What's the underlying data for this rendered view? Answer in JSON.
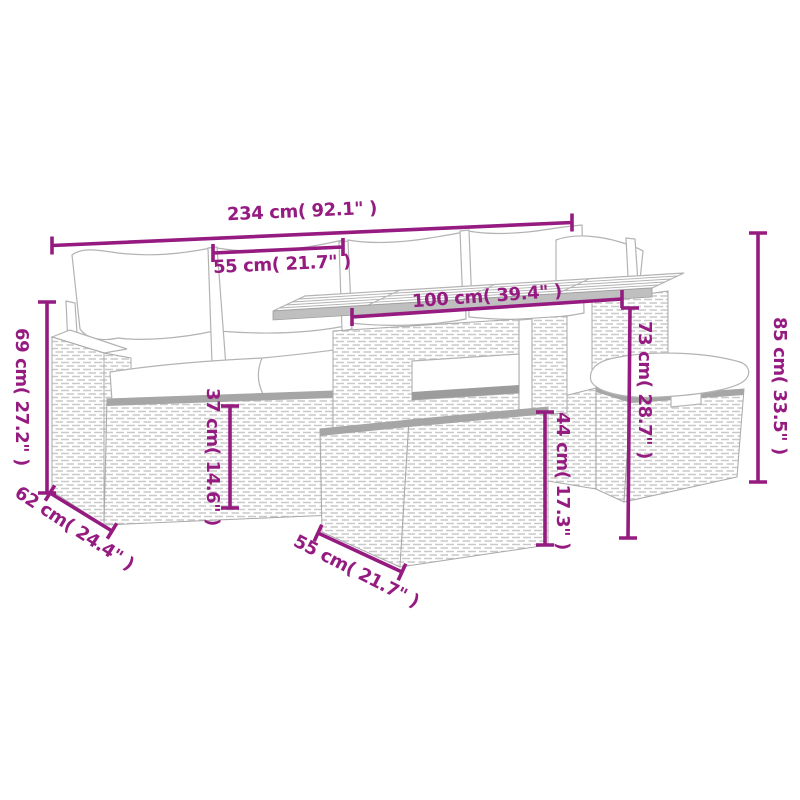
{
  "diagram": {
    "accent_color": "#951b81",
    "line_art_color": "#b3b3b3",
    "background_color": "#ffffff",
    "dimensions": [
      {
        "id": "total-width",
        "label": "234 cm( 92.1\" )"
      },
      {
        "id": "seat-width",
        "label": "55 cm( 21.7\" )"
      },
      {
        "id": "table-top-width",
        "label": "100 cm( 39.4\" )"
      },
      {
        "id": "total-height",
        "label": "85 cm( 33.5\" )"
      },
      {
        "id": "table-height",
        "label": "73 cm( 28.7\" )"
      },
      {
        "id": "table-base-height",
        "label": "44 cm( 17.3\" )"
      },
      {
        "id": "seat-height",
        "label": "37 cm( 14.6\" )"
      },
      {
        "id": "back-height",
        "label": "69 cm( 27.2\" )"
      },
      {
        "id": "seat-depth",
        "label": "62 cm( 24.4\" )"
      },
      {
        "id": "table-base-width",
        "label": "55 cm( 21.7\" )"
      }
    ]
  }
}
